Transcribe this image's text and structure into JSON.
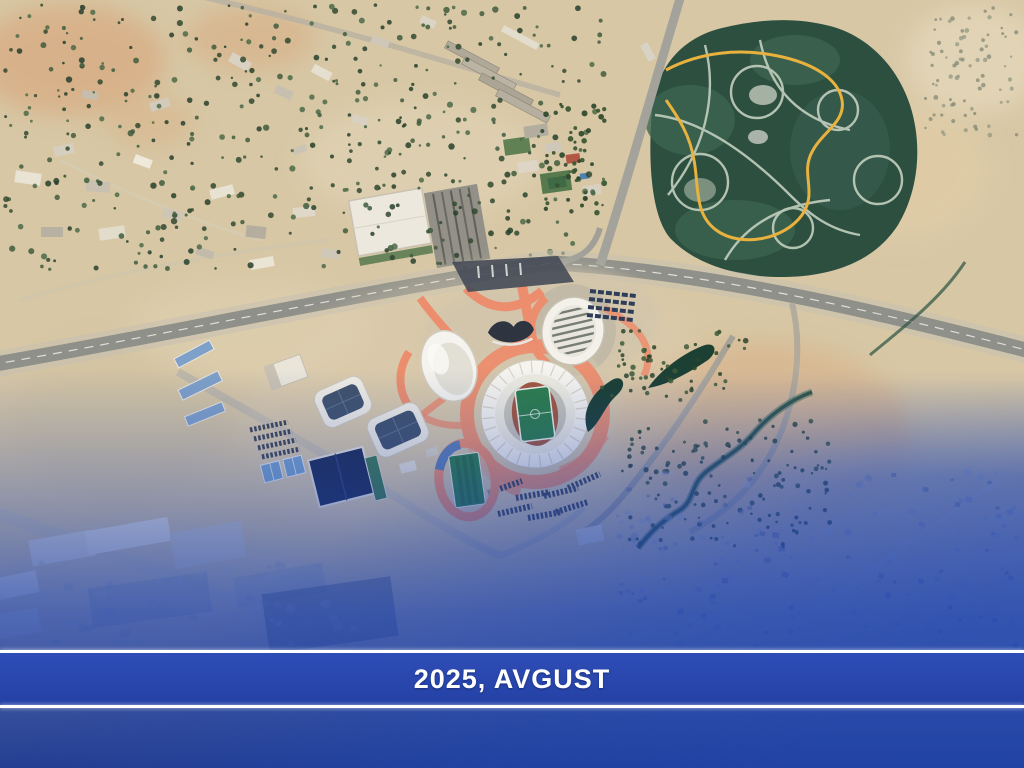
{
  "caption": {
    "text": "2025, AVGUST"
  },
  "colors": {
    "desert_tan": "#d7c7a5",
    "park_green": "#2d4f40",
    "trail_yellow": "#e9b23f",
    "path_salmon": "#ec8d6d",
    "pitch_green": "#2e7d4b",
    "overlay": "#1c41ad",
    "banner": "#2e4db6",
    "banner_dark": "#2441a5",
    "banner_line": "#ffffff",
    "caption_text": "#ffffff"
  },
  "map": {
    "kind": "satellite-imagery",
    "landmarks": [
      "olympic sports complex",
      "main stadium",
      "striped-roof arena",
      "oval arena",
      "glass-roof pavilions",
      "training field",
      "parking lots",
      "city park with trails",
      "highway interchange",
      "desert urban district",
      "industrial warehouses",
      "residential district",
      "winding canal"
    ]
  }
}
